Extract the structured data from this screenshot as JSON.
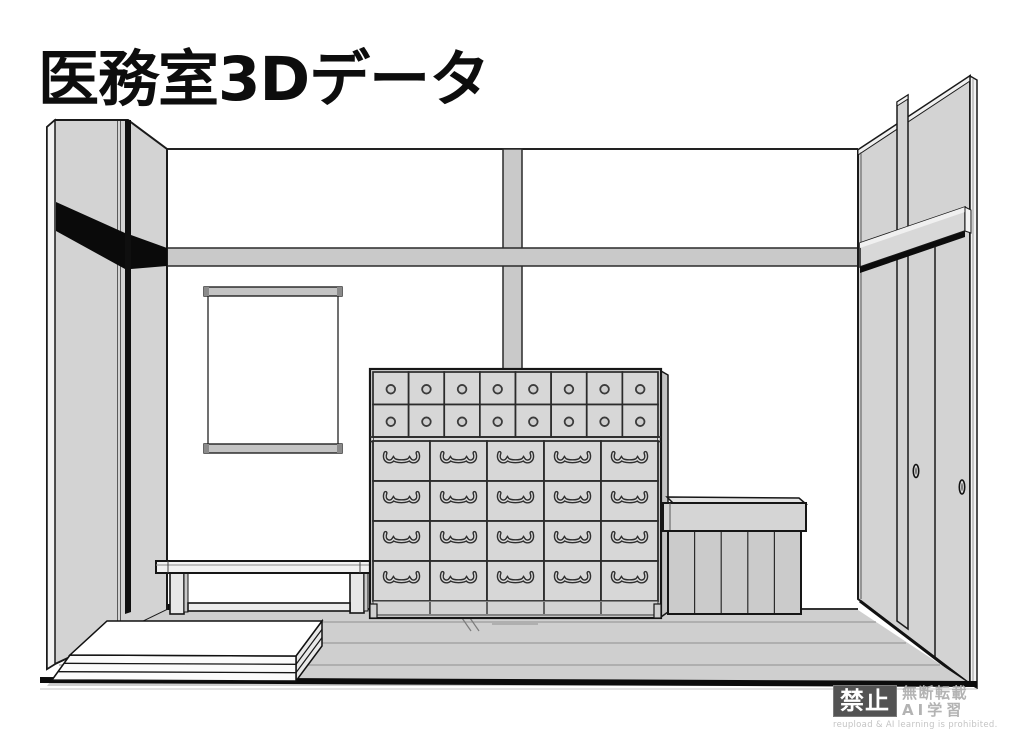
{
  "title": "医務室3Dデータ",
  "watermark": {
    "badge": "禁止",
    "line1": "無断転載",
    "line2": "AI学習",
    "caption": "reupload & AI learning is prohibited."
  },
  "colors": {
    "background": "#ffffff",
    "outline": "#1a1a1a",
    "wall_gray": "#d3d3d3",
    "floor_gray": "#cfcfcf",
    "rail_gray": "#c9c9c9",
    "shadow_black": "#0c0c0c",
    "watermark_badge_bg": "#535353",
    "watermark_text_gray": "#b3b3b3"
  },
  "cabinet": {
    "small_drawer_rows": 2,
    "small_drawer_cols": 8,
    "large_drawer_rows": 4,
    "large_drawer_cols": 5
  },
  "box": {
    "planks": 5
  },
  "mats": {
    "layers": 3
  }
}
